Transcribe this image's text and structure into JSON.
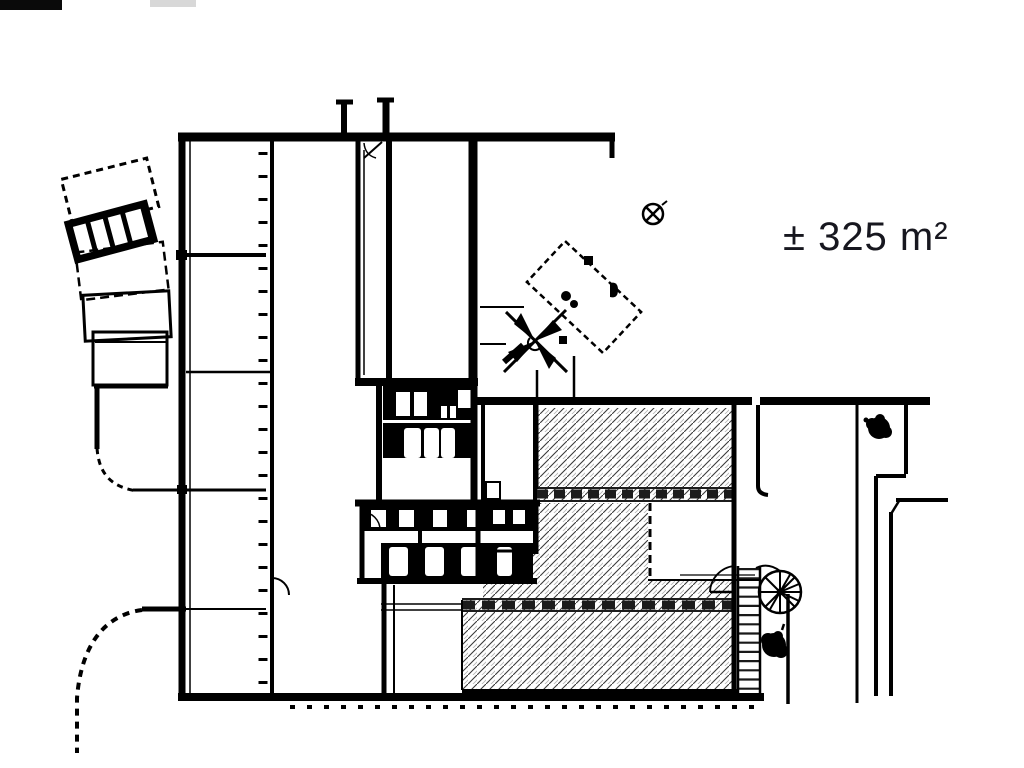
{
  "page": {
    "background_color": "#ffffff",
    "line_color": "#000000",
    "hatch_color": "#3a3a3a",
    "kind": "architectural floor plan drawing"
  },
  "annotation": {
    "area_label": "± 325 m²",
    "label_color": "#17171f"
  },
  "symbols": [
    "spiral-staircase-icon",
    "ladder-stair-icon",
    "tree-icon-right",
    "tree-icon-lower",
    "survey-marker-icon",
    "vehicle-icon",
    "gate-icon"
  ],
  "zones": {
    "hatched_zone": "leased area (diagonal hatching)",
    "left_wing": "left building wing with window wall",
    "sanitary_block": "central sanitary rooms",
    "curved_annex": "curved stall annex at far left"
  }
}
